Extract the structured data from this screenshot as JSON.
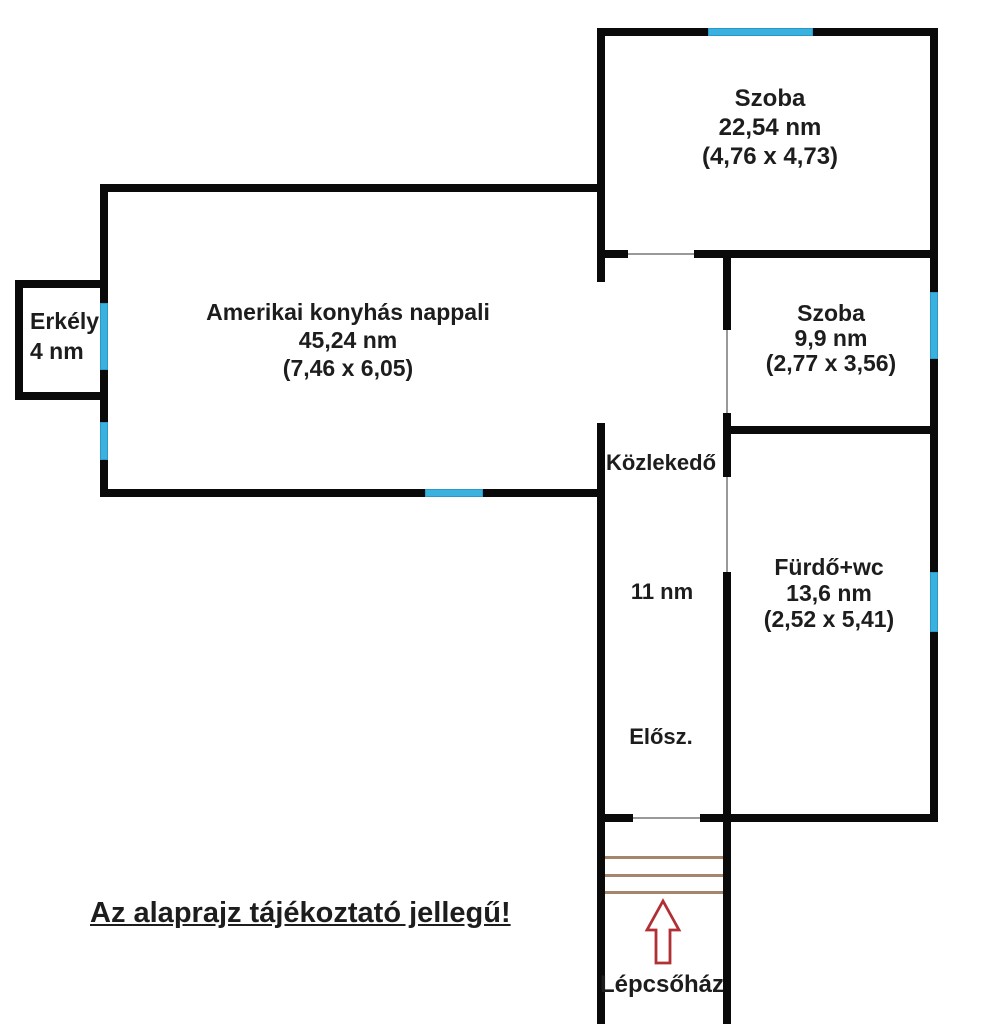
{
  "plan": {
    "disclaimer": "Az alaprajz tájékoztató jellegű!",
    "rooms": {
      "szoba_nagy": {
        "name": "Szoba",
        "area": "22,54 nm",
        "dims": "(4,76 x 4,73)"
      },
      "szoba_kis": {
        "name": "Szoba",
        "area": "9,9 nm",
        "dims": "(2,77 x 3,56)"
      },
      "nappali": {
        "name": "Amerikai konyhás nappali",
        "area": "45,24 nm",
        "dims": "(7,46 x 6,05)"
      },
      "furdo": {
        "name": "Fürdő+wc",
        "area": "13,6 nm",
        "dims": "(2,52 x 5,41)"
      },
      "erkely": {
        "name": "Erkély",
        "area": "4 nm"
      },
      "kozlekedo": {
        "name": "Közlekedő",
        "area": "11 nm"
      },
      "eloszoba": {
        "name": "Elősz."
      },
      "lepcsohaz": {
        "name": "Lépcsőház"
      }
    },
    "colors": {
      "wall": "#0a0a0a",
      "window": "#3bb1e0",
      "stair_line": "#a7846c",
      "arrow_outline": "#b03036",
      "door_line": "#999999"
    }
  }
}
